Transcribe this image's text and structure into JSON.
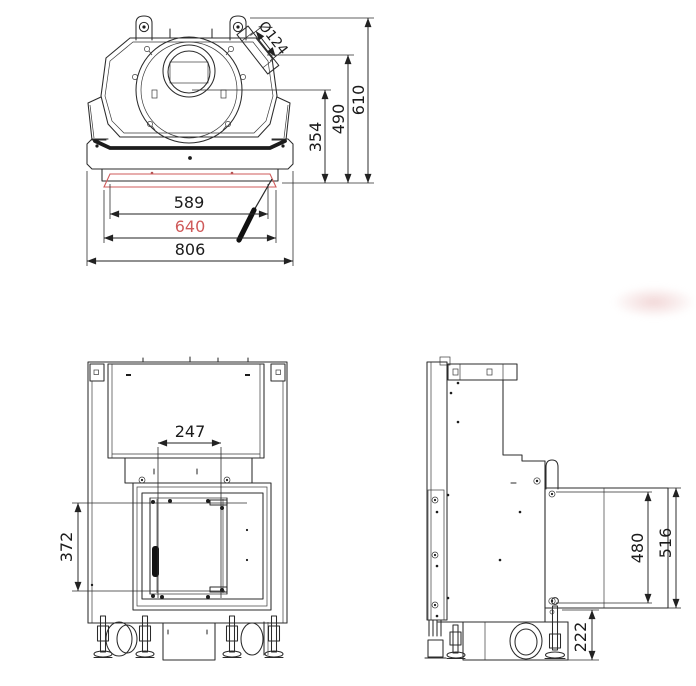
{
  "drawing_title": "fireplace-insert-technical-drawing",
  "colors": {
    "line": "#2b2b2b",
    "accent_red": "#cf5b5b"
  },
  "views": {
    "top": {
      "label": "top-view",
      "dims": {
        "flue_dia": "Ø124",
        "inner_width": "589",
        "glass_width": "640",
        "overall_width": "806",
        "flue_center_depth": "354",
        "mid_depth": "490",
        "overall_depth": "610"
      }
    },
    "front": {
      "label": "front-view",
      "dims": {
        "opening_width": "247",
        "opening_height": "372"
      }
    },
    "side": {
      "label": "side-view",
      "dims": {
        "glass_height": "480",
        "frame_height": "516",
        "base_height": "222"
      }
    }
  }
}
